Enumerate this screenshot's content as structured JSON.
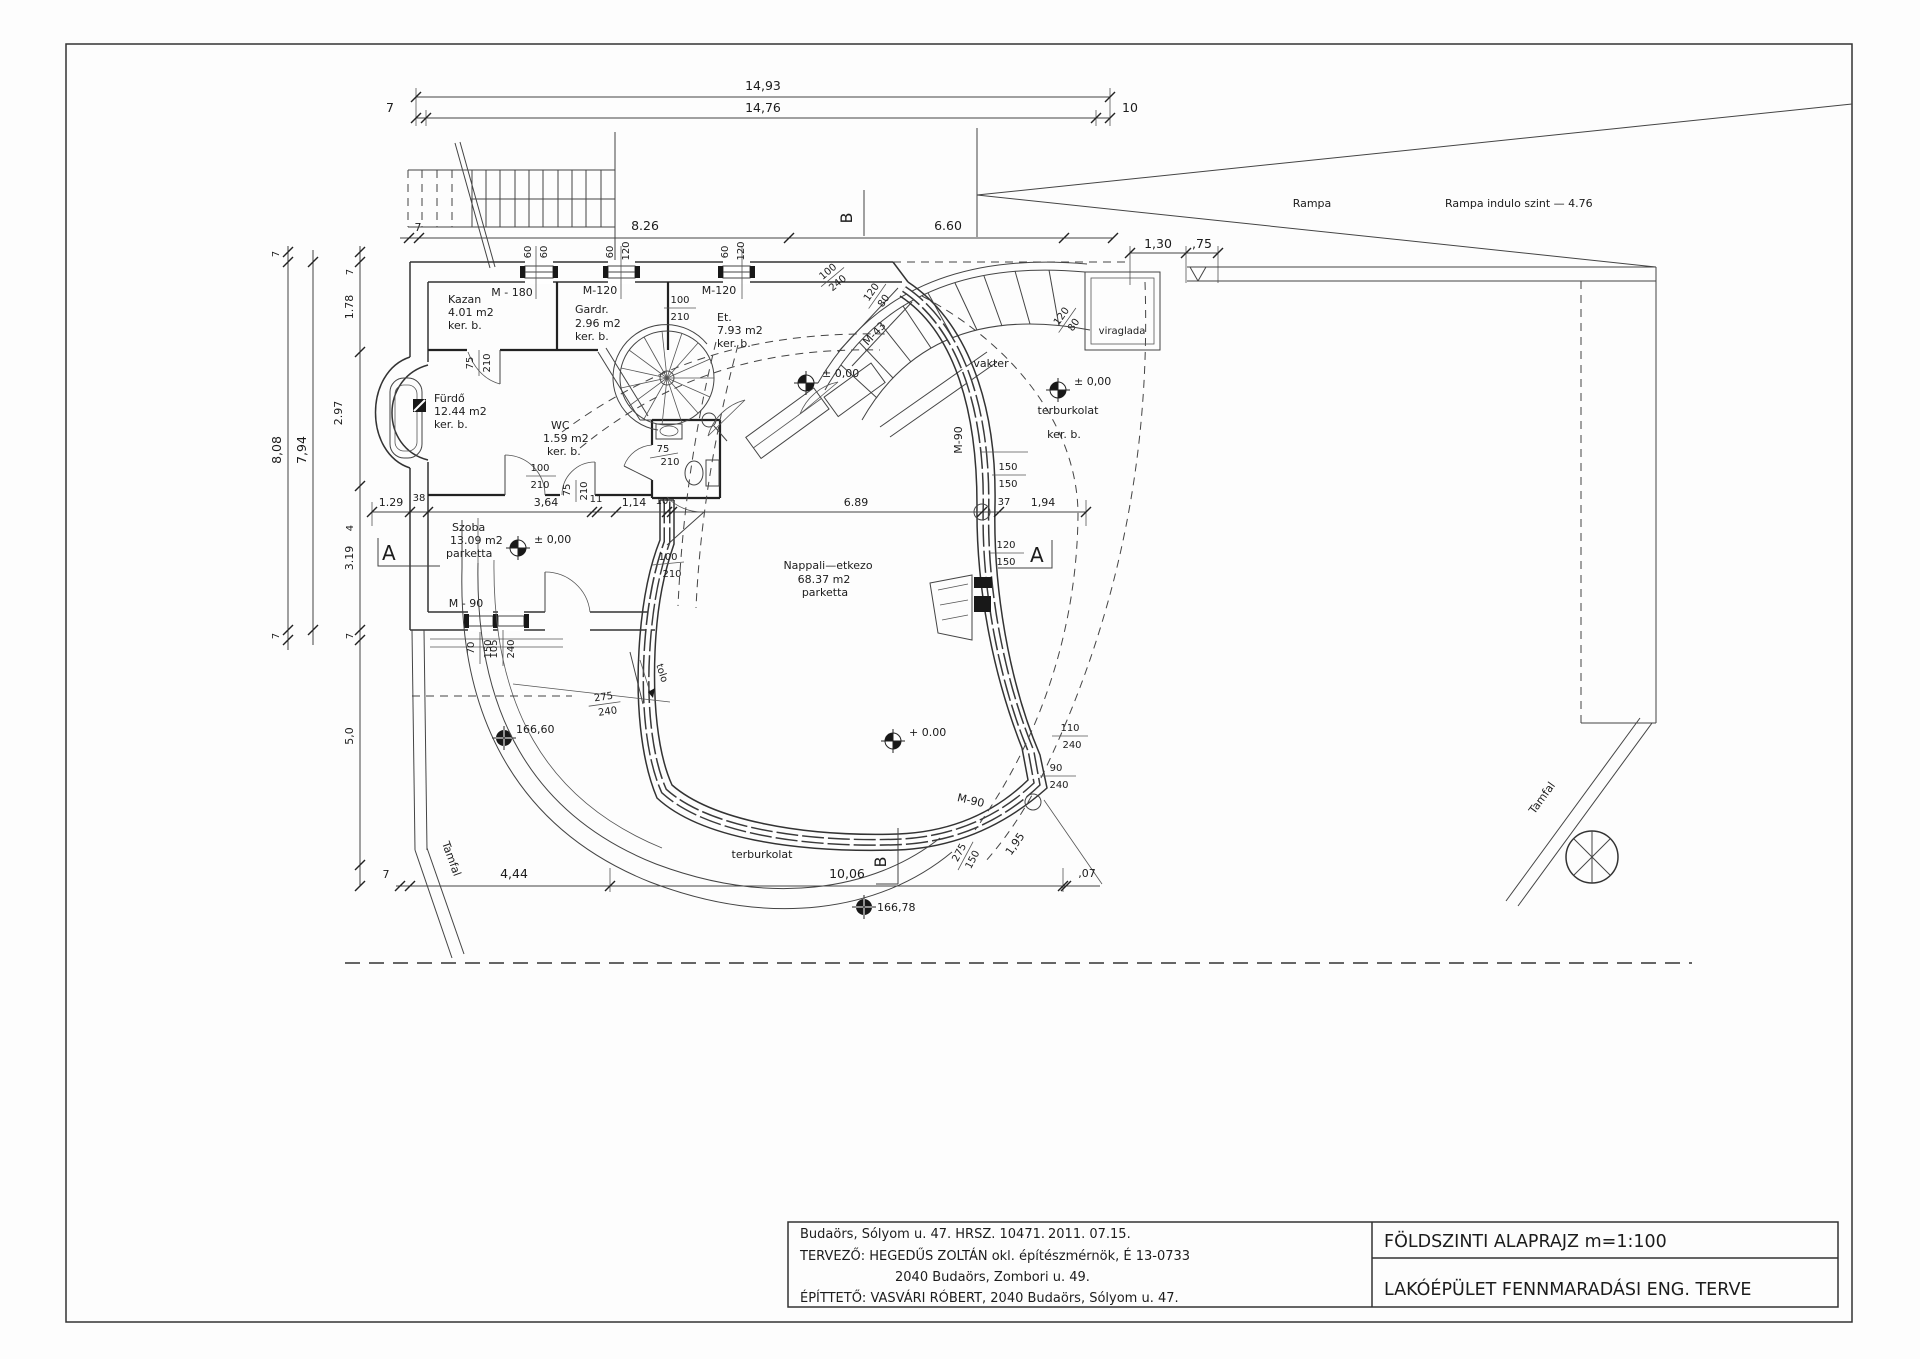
{
  "tb": {
    "l1": "Budaörs, Sólyom u. 47. HRSZ. 10471.",
    "date": "2011. 07.15.",
    "l2": "TERVEZŐ:  HEGEDŰS ZOLTÁN  okl. építészmérnök, É 13-0733",
    "l3": "2040 Budaörs, Zombori u. 49.",
    "l4": "ÉPÍTTETŐ: VASVÁRI RÓBERT, 2040 Budaörs, Sólyom u. 47.",
    "t1": "FÖLDSZINTI ALAPRAJZ m=1:100",
    "t2": "LAKÓÉPÜLET FENNMARADÁSI ENG. TERVE"
  },
  "rooms": {
    "kazan": {
      "name": "Kazan",
      "area": "4.01 m2",
      "fin": "ker. b."
    },
    "gardr": {
      "name": "Gardr.",
      "area": "2.96 m2",
      "fin": "ker. b."
    },
    "et": {
      "name": "Et.",
      "area": "7.93 m2",
      "fin": "ker. b."
    },
    "furdo": {
      "name": "Fürdő",
      "area": "12.44 m2",
      "fin": "ker. b."
    },
    "wc": {
      "name": "WC",
      "area": "1.59 m2",
      "fin": "ker. b."
    },
    "szoba": {
      "name": "Szoba",
      "area": "13.09 m2",
      "fin": "parketta"
    },
    "nappali": {
      "name": "Nappali—etkezo",
      "area": "68.37 m2",
      "fin": "parketta"
    }
  },
  "site": {
    "rampa": "Rampa",
    "rampa_level": "Rampa indulo szint — 4.76",
    "viraglada": "viraglada",
    "vakter": "vakter",
    "terb1": "terburkolat",
    "terb1b": "ker. b.",
    "terb2": "terburkolat",
    "tamfal_l": "Tamfal",
    "tamfal_r": "Tamfal",
    "tolo": "tolo"
  },
  "lv": {
    "z1": "± 0,00",
    "z2": "± 0,00",
    "z3": "± 0,00",
    "z4": "+ 0.00",
    "s1": "166,60",
    "s2": "166,78"
  },
  "dm": {
    "t1": "14,93",
    "t2": "14,76",
    "g7": "7",
    "g10": "10",
    "r2g": "7",
    "r2a": "8.26",
    "r2b": "6.60",
    "r2c": "1,30",
    "r2d": ",75",
    "lt": "8,08",
    "li": "7,94",
    "lg1": "7",
    "lg2": "7",
    "c7a": "7",
    "c178": "1.78",
    "c297": "2.97",
    "c4": "4",
    "c319": "3.19",
    "c7b": "7",
    "c50": "5,0",
    "m129": "1.29",
    "m38": "38",
    "m364": "3,64",
    "m11": "11",
    "m114": "1,14",
    "m10": "10",
    "m689": "6.89",
    "m37": "37",
    "m194": "1,94",
    "b7": "7",
    "b444": "4,44",
    "b1006": "10,06",
    "b07": ",07",
    "b195": "1,95"
  },
  "dr": {
    "m180": "M - 180",
    "m120a": "M-120",
    "m120b": "M-120",
    "m43": "M-43",
    "m90a": "M-90",
    "m90b": "M - 90",
    "m90c": "M-90"
  },
  "op": {
    "w1a": "60",
    "w1b": "60",
    "w2a": "60",
    "w2b": "120",
    "w3a": "60",
    "w3b": "120",
    "f1n": "100",
    "f1d": "210",
    "f2n": "75",
    "f2d": "210",
    "f3n": "75",
    "f3d": "210",
    "f4n": "100",
    "f4d": "210",
    "f5n": "100",
    "f5d": "240",
    "f6n": "120",
    "f6d": "80",
    "f7n": "120",
    "f7d": "80",
    "f8n": "150",
    "f8d": "150",
    "f9n": "120",
    "f9d": "150",
    "f10n": "70",
    "f10d": "150",
    "f11n": "105",
    "f11d": "240",
    "f12n": "275",
    "f12d": "240",
    "f13n": "110",
    "f13d": "240",
    "f14n": "90",
    "f14d": "240",
    "f15n": "275",
    "f15d": "150",
    "f16n": "75",
    "f16d": "210",
    "f17n": "100",
    "f17d": "210"
  },
  "sec": {
    "a": "A",
    "b": "B"
  }
}
